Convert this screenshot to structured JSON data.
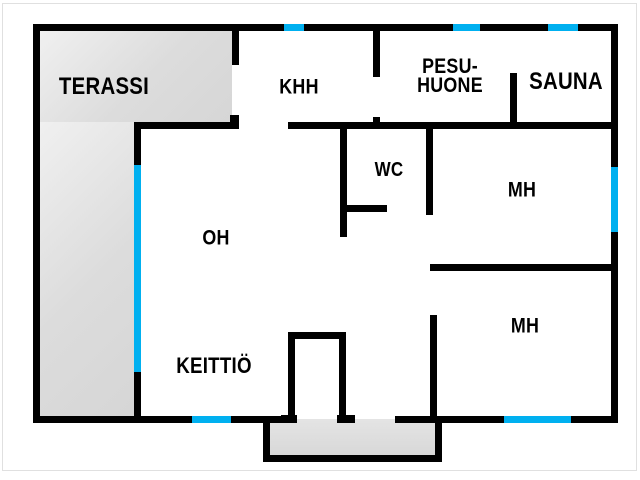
{
  "plan": {
    "title": "floor-plan",
    "colors": {
      "wall": "#000000",
      "window": "#00b0f0",
      "floor": "#ffffff",
      "outdoor_fill": "#dcdcdc"
    },
    "rooms": {
      "terassi": {
        "label": "TERASSI"
      },
      "khh": {
        "label": "KHH"
      },
      "pesuhuone": {
        "label_line1": "PESU-",
        "label_line2": "HUONE"
      },
      "sauna": {
        "label": "SAUNA"
      },
      "wc": {
        "label": "WC"
      },
      "mh_top": {
        "label": "MH"
      },
      "oh": {
        "label": "OH"
      },
      "mh_bottom": {
        "label": "MH"
      },
      "keittio": {
        "label": "KEITTIÖ"
      }
    }
  }
}
